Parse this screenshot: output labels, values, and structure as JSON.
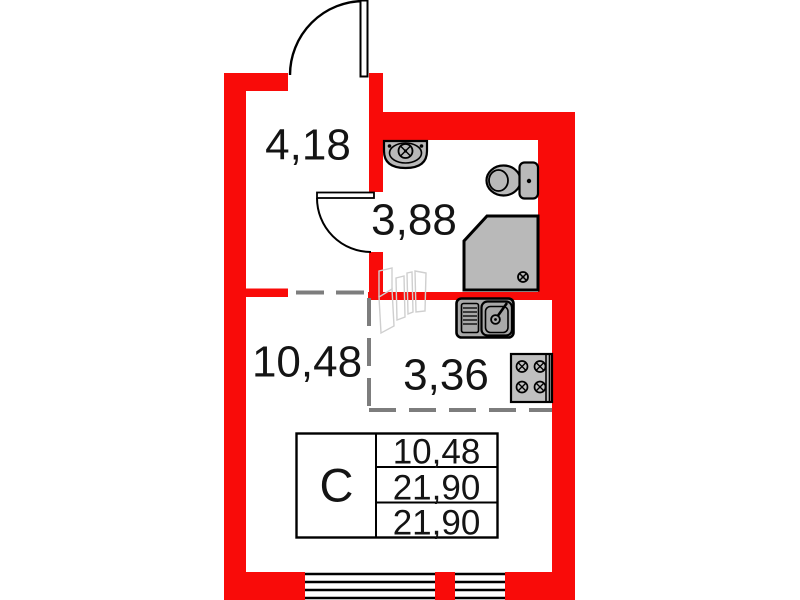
{
  "plan": {
    "title": "studio-apartment-floor-plan",
    "rooms": {
      "hallway": {
        "area": "4,18"
      },
      "bathroom": {
        "area": "3,88"
      },
      "living_room": {
        "area": "10,48"
      },
      "kitchen": {
        "area": "3,36"
      }
    },
    "info_table": {
      "type": "С",
      "rows": [
        "10,48",
        "21,90",
        "21,90"
      ]
    },
    "colors": {
      "wall": "#f90b09",
      "fixture": "#b9b9b9",
      "fixture_dark": "#a8a8a8",
      "stove": "#c0c0c0",
      "dashes": "#7d7d7d",
      "lines": "#000000",
      "ghost": "#cfcfcf"
    },
    "icons": [
      "entrance-door-arc",
      "bathroom-door-arc",
      "bathroom-sink-icon",
      "toilet-icon",
      "shower-tray-icon",
      "kitchen-sink-icon",
      "stove-icon",
      "window-hatch",
      "drain-icon",
      "faucet-icon"
    ]
  }
}
